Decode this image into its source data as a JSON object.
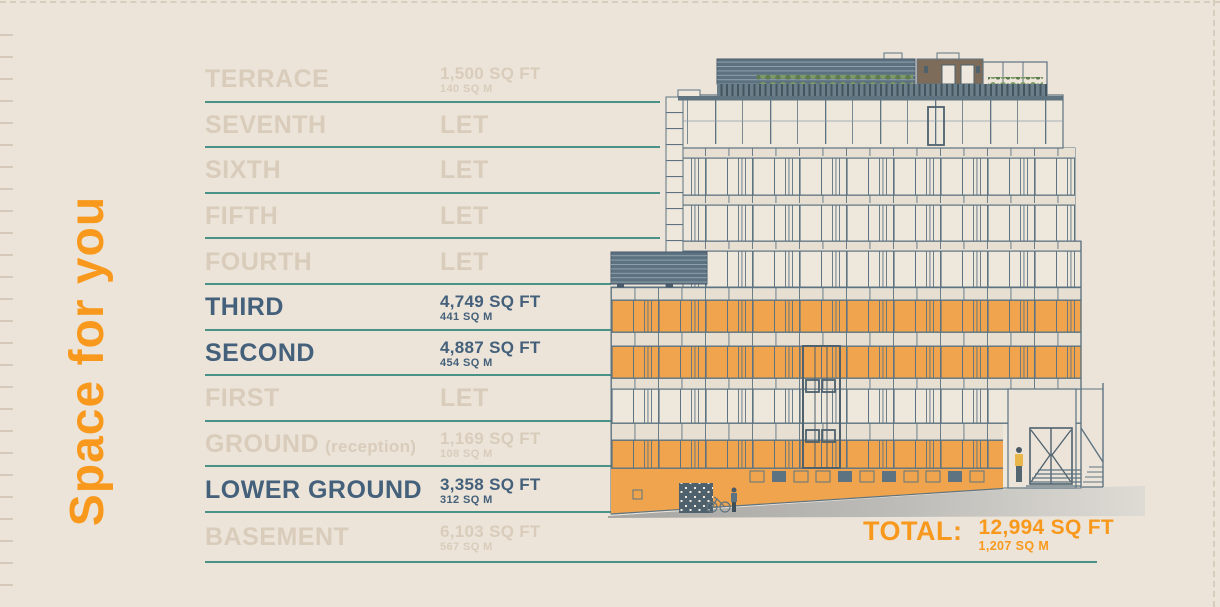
{
  "title": {
    "text": "Space for you"
  },
  "floors": [
    {
      "name": "TERRACE",
      "area_sqft": "1,500 SQ FT",
      "area_sqm": "140 SQ M",
      "state": "muted",
      "line": "long"
    },
    {
      "name": "SEVENTH",
      "let_label": "LET",
      "state": "let",
      "line": "long"
    },
    {
      "name": "SIXTH",
      "let_label": "LET",
      "state": "let",
      "line": "long"
    },
    {
      "name": "FIFTH",
      "let_label": "LET",
      "state": "let",
      "line": "long"
    },
    {
      "name": "FOURTH",
      "let_label": "LET",
      "state": "let",
      "line": "short"
    },
    {
      "name": "THIRD",
      "area_sqft": "4,749 SQ FT",
      "area_sqm": "441 SQ M",
      "state": "available",
      "line": "short"
    },
    {
      "name": "SECOND",
      "area_sqft": "4,887 SQ FT",
      "area_sqm": "454 SQ M",
      "state": "available",
      "line": "short"
    },
    {
      "name": "FIRST",
      "let_label": "LET",
      "state": "let",
      "line": "short"
    },
    {
      "name": "GROUND",
      "suffix": "(reception)",
      "area_sqft": "1,169 SQ FT",
      "area_sqm": "108 SQ M",
      "state": "muted",
      "line": "short"
    },
    {
      "name": "LOWER GROUND",
      "area_sqft": "3,358 SQ FT",
      "area_sqm": "312 SQ M",
      "state": "available",
      "line": "short"
    },
    {
      "name": "BASEMENT",
      "area_sqft": "6,103 SQ FT",
      "area_sqm": "567 SQ M",
      "state": "muted",
      "line": "none"
    }
  ],
  "total": {
    "label": "TOTAL:",
    "area_sqft": "12,994 SQ FT",
    "area_sqm": "1,207 SQ M"
  },
  "illustration": {
    "name": "building-elevation",
    "highlighted_floors": [
      "THIRD",
      "SECOND",
      "GROUND",
      "LOWER GROUND"
    ]
  },
  "colors": {
    "background": "#ece4d9",
    "accent_orange": "#f8991d",
    "floor_band_orange": "#efa44d",
    "teal_rule": "#4a9187",
    "active_text_slate": "#44607a",
    "muted_text": "#d9ccbb",
    "drawing_line_slate": "#5d7381"
  }
}
